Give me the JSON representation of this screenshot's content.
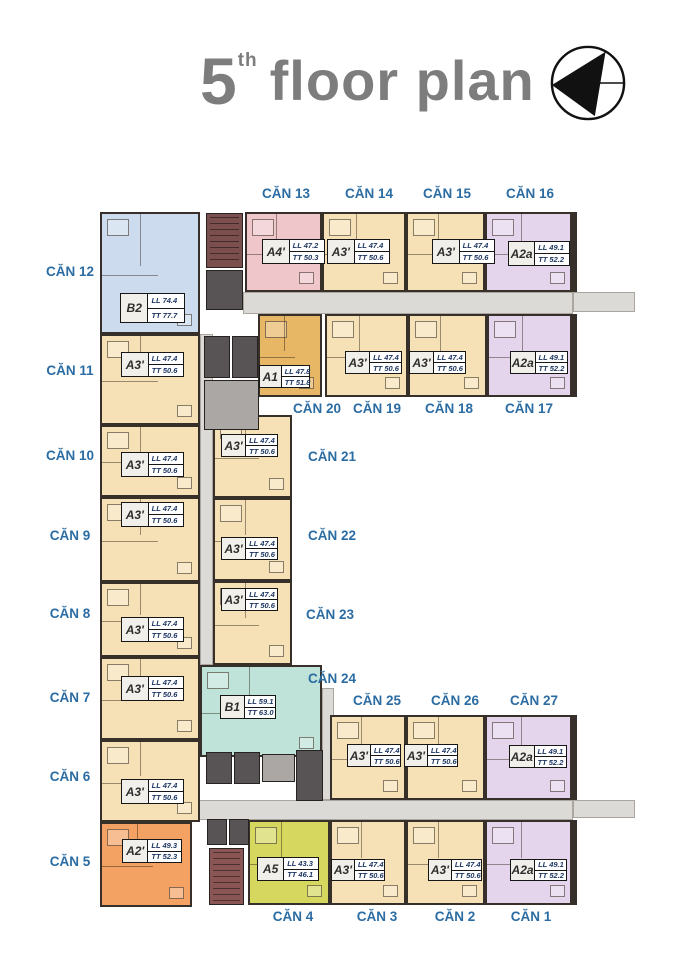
{
  "title": {
    "floor_number": "5",
    "ordinal_suffix": "th",
    "label": "floor plan"
  },
  "palette": {
    "tan": "#f5e1b5",
    "pink": "#efc6ca",
    "lavender": "#e4d5ec",
    "blue": "#ccdcee",
    "gold": "#e7b766",
    "orange": "#f3a263",
    "lime": "#d5d75f",
    "teal": "#bfe2d9",
    "corridor": "#dcdad7",
    "core_dark": "#585355",
    "stair_maroon": "#7c4f4f",
    "wall": "#37302a",
    "can_label_blue": "#2b6ca3",
    "title_gray": "#7d7d7d"
  },
  "units": [
    {
      "can": "CĂN 1",
      "type": "A2a",
      "ll": "LL 49.1",
      "tt": "TT 52.2",
      "color": "lavender",
      "rect": [
        485,
        820,
        88,
        85
      ],
      "label_box": [
        510,
        859,
        57,
        22
      ],
      "can_pos": [
        500,
        909,
        62
      ]
    },
    {
      "can": "CĂN 2",
      "type": "A3'",
      "ll": "LL 47.4",
      "tt": "TT 50.6",
      "color": "tan",
      "rect": [
        406,
        820,
        79,
        85
      ],
      "label_box": [
        428,
        859,
        54,
        22
      ],
      "can_pos": [
        424,
        909,
        62
      ]
    },
    {
      "can": "CĂN 3",
      "type": "A3'",
      "ll": "LL 47.4",
      "tt": "TT 50.6",
      "color": "tan",
      "rect": [
        330,
        820,
        76,
        85
      ],
      "label_box": [
        331,
        859,
        54,
        22
      ],
      "can_pos": [
        346,
        909,
        62
      ]
    },
    {
      "can": "CĂN 4",
      "type": "A5",
      "ll": "LL 43.3",
      "tt": "TT 46.1",
      "color": "lime",
      "rect": [
        248,
        820,
        82,
        85
      ],
      "label_box": [
        257,
        857,
        62,
        24
      ],
      "can_pos": [
        262,
        909,
        62
      ]
    },
    {
      "can": "CĂN 5",
      "type": "A2'",
      "ll": "LL 49.3",
      "tt": "TT 52.3",
      "color": "orange",
      "rect": [
        100,
        822,
        92,
        85
      ],
      "label_box": [
        122,
        839,
        60,
        24
      ],
      "can_pos": [
        44,
        854,
        52
      ]
    },
    {
      "can": "CĂN 6",
      "type": "A3'",
      "ll": "LL 47.4",
      "tt": "TT 50.6",
      "color": "tan",
      "rect": [
        100,
        740,
        100,
        82
      ],
      "label_box": [
        121,
        779,
        63,
        25
      ],
      "can_pos": [
        44,
        769,
        52
      ]
    },
    {
      "can": "CĂN 7",
      "type": "A3'",
      "ll": "LL 47.4",
      "tt": "TT 50.6",
      "color": "tan",
      "rect": [
        100,
        657,
        100,
        83
      ],
      "label_box": [
        121,
        676,
        63,
        25
      ],
      "can_pos": [
        44,
        690,
        52
      ]
    },
    {
      "can": "CĂN 8",
      "type": "A3'",
      "ll": "LL 47.4",
      "tt": "TT 50.6",
      "color": "tan",
      "rect": [
        100,
        582,
        100,
        75
      ],
      "label_box": [
        121,
        617,
        63,
        25
      ],
      "can_pos": [
        44,
        606,
        52
      ]
    },
    {
      "can": "CĂN 9",
      "type": "A3'",
      "ll": "LL 47.4",
      "tt": "TT 50.6",
      "color": "tan",
      "rect": [
        100,
        497,
        100,
        85
      ],
      "label_box": [
        121,
        502,
        63,
        25
      ],
      "can_pos": [
        44,
        528,
        52
      ]
    },
    {
      "can": "CĂN 10",
      "type": "A3'",
      "ll": "LL 47.4",
      "tt": "TT 50.6",
      "color": "tan",
      "rect": [
        100,
        425,
        100,
        72
      ],
      "label_box": [
        121,
        452,
        63,
        25
      ],
      "can_pos": [
        44,
        448,
        52
      ]
    },
    {
      "can": "CĂN 11",
      "type": "A3'",
      "ll": "LL 47.4",
      "tt": "TT 50.6",
      "color": "tan",
      "rect": [
        100,
        334,
        100,
        91
      ],
      "label_box": [
        121,
        352,
        63,
        25
      ],
      "can_pos": [
        44,
        363,
        52
      ]
    },
    {
      "can": "CĂN 12",
      "type": "B2",
      "ll": "LL 74.4",
      "tt": "TT 77.7",
      "color": "blue",
      "rect": [
        100,
        212,
        100,
        122
      ],
      "label_box": [
        120,
        293,
        65,
        30
      ],
      "can_pos": [
        44,
        264,
        52
      ]
    },
    {
      "can": "CĂN 13",
      "type": "A4'",
      "ll": "LL 47.2",
      "tt": "TT 50.3",
      "color": "pink",
      "rect": [
        245,
        212,
        77,
        80
      ],
      "label_box": [
        262,
        239,
        63,
        25
      ],
      "can_pos": [
        251,
        186,
        70
      ]
    },
    {
      "can": "CĂN 14",
      "type": "A3'",
      "ll": "LL 47.4",
      "tt": "TT 50.6",
      "color": "tan",
      "rect": [
        322,
        212,
        84,
        80
      ],
      "label_box": [
        327,
        239,
        63,
        25
      ],
      "can_pos": [
        334,
        186,
        70
      ]
    },
    {
      "can": "CĂN 15",
      "type": "A3'",
      "ll": "LL 47.4",
      "tt": "TT 50.6",
      "color": "tan",
      "rect": [
        406,
        212,
        79,
        80
      ],
      "label_box": [
        432,
        239,
        63,
        25
      ],
      "can_pos": [
        412,
        186,
        70
      ]
    },
    {
      "can": "CĂN 16",
      "type": "A2a",
      "ll": "LL 49.1",
      "tt": "TT 52.2",
      "color": "lavender",
      "rect": [
        485,
        212,
        88,
        80
      ],
      "label_box": [
        508,
        241,
        62,
        25
      ],
      "can_pos": [
        495,
        186,
        70
      ]
    },
    {
      "can": "CĂN 17",
      "type": "A2a",
      "ll": "LL 49.1",
      "tt": "TT 52.2",
      "color": "lavender",
      "rect": [
        487,
        314,
        86,
        83
      ],
      "label_box": [
        510,
        351,
        58,
        23
      ],
      "can_pos": [
        500,
        401,
        58
      ]
    },
    {
      "can": "CĂN 18",
      "type": "A3'",
      "ll": "LL 47.4",
      "tt": "TT 50.6",
      "color": "tan",
      "rect": [
        408,
        314,
        79,
        83
      ],
      "label_box": [
        409,
        351,
        57,
        23
      ],
      "can_pos": [
        420,
        401,
        58
      ]
    },
    {
      "can": "CĂN 19",
      "type": "A3'",
      "ll": "LL 47.4",
      "tt": "TT 50.6",
      "color": "tan",
      "rect": [
        325,
        314,
        83,
        83
      ],
      "label_box": [
        345,
        351,
        57,
        23
      ],
      "can_pos": [
        348,
        401,
        58
      ]
    },
    {
      "can": "CĂN 20",
      "type": "A1",
      "ll": "LL 47.8",
      "tt": "TT 51.8",
      "color": "gold",
      "rect": [
        258,
        314,
        64,
        83
      ],
      "label_box": [
        259,
        365,
        51,
        23
      ],
      "can_pos": [
        288,
        401,
        58
      ]
    },
    {
      "can": "CĂN 21",
      "type": "A3'",
      "ll": "LL 47.4",
      "tt": "TT 50.6",
      "color": "tan",
      "rect": [
        213,
        415,
        79,
        83
      ],
      "label_box": [
        221,
        434,
        57,
        23
      ],
      "can_pos": [
        303,
        449,
        58
      ]
    },
    {
      "can": "CĂN 22",
      "type": "A3'",
      "ll": "LL 47.4",
      "tt": "TT 50.6",
      "color": "tan",
      "rect": [
        213,
        498,
        79,
        83
      ],
      "label_box": [
        221,
        537,
        57,
        23
      ],
      "can_pos": [
        303,
        528,
        58
      ]
    },
    {
      "can": "CĂN 23",
      "type": "A3'",
      "ll": "LL 47.4",
      "tt": "TT 50.6",
      "color": "tan",
      "rect": [
        213,
        581,
        79,
        84
      ],
      "label_box": [
        221,
        588,
        57,
        23
      ],
      "can_pos": [
        301,
        607,
        58
      ]
    },
    {
      "can": "CĂN 24",
      "type": "B1",
      "ll": "LL 59.1",
      "tt": "TT 63.0",
      "color": "teal",
      "rect": [
        200,
        665,
        122,
        92
      ],
      "label_box": [
        220,
        695,
        56,
        24
      ],
      "can_pos": [
        303,
        671,
        58
      ]
    },
    {
      "can": "CĂN 25",
      "type": "A3'",
      "ll": "LL 47.4",
      "tt": "TT 50.6",
      "color": "tan",
      "rect": [
        330,
        715,
        76,
        85
      ],
      "label_box": [
        347,
        744,
        54,
        23
      ],
      "can_pos": [
        346,
        693,
        62
      ]
    },
    {
      "can": "CĂN 26",
      "type": "A3'",
      "ll": "LL 47.4",
      "tt": "TT 50.6",
      "color": "tan",
      "rect": [
        406,
        715,
        79,
        85
      ],
      "label_box": [
        404,
        744,
        54,
        23
      ],
      "can_pos": [
        424,
        693,
        62
      ]
    },
    {
      "can": "CĂN 27",
      "type": "A2a",
      "ll": "LL 49.1",
      "tt": "TT 52.2",
      "color": "lavender",
      "rect": [
        485,
        715,
        88,
        85
      ],
      "label_box": [
        509,
        745,
        58,
        23
      ],
      "can_pos": [
        503,
        693,
        62
      ]
    }
  ]
}
